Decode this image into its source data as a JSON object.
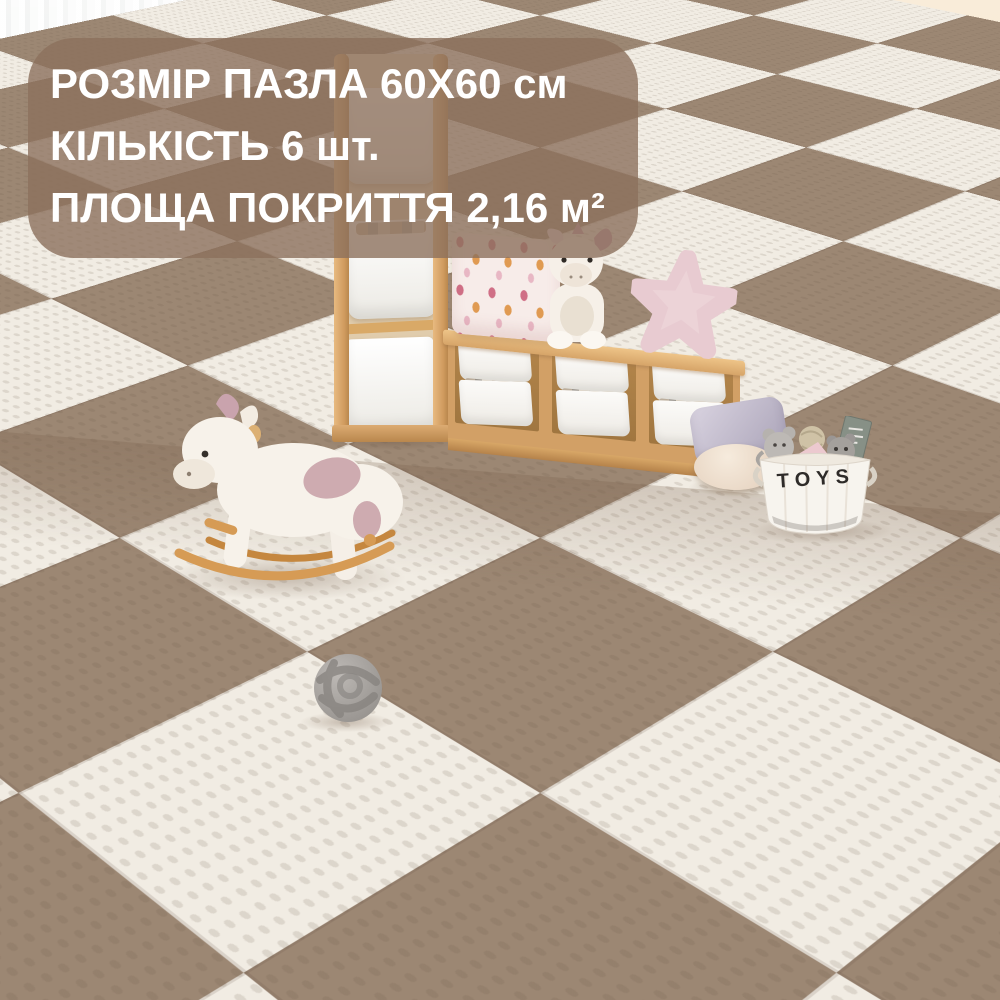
{
  "overlay": {
    "line1": "РОЗМІР ПАЗЛА 60X60 см",
    "line2": "КІЛЬКІСТЬ 6 шт.",
    "line3": "ПЛОЩА ПОКРИТТЯ 2,16 м²",
    "background_color": "#97806c",
    "text_color": "#ffffff"
  },
  "wall_decor": {
    "hello_sign_text": "hello",
    "hello_sign_color": "#93c0ea",
    "star_color": "#f2d482"
  },
  "toys_basket": {
    "label": "TOYS"
  },
  "mat": {
    "tile_color_brown": "#9c8773",
    "tile_color_white": "#f1ece3"
  }
}
